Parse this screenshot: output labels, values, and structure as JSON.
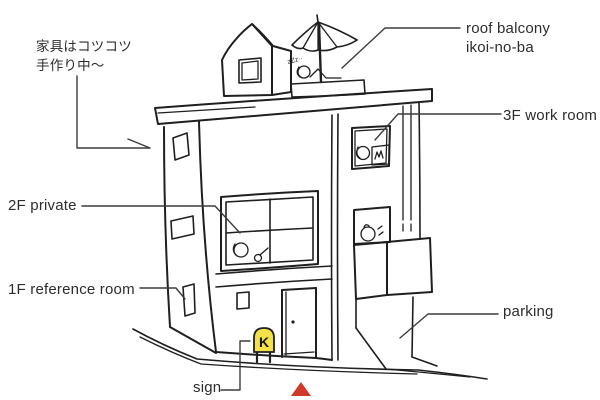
{
  "colors": {
    "ink": "#1f1f1f",
    "leader": "#3c3c3c",
    "label_text": "#2d2d2d",
    "sign_yellow": "#f2e14b",
    "marker_red": "#cf3928"
  },
  "labels": {
    "handmade_note": "家具はコツコツ\n手作り中〜",
    "roof_balcony": "roof balcony\nikoi-no-ba",
    "floor3_work_room": "3F work room",
    "floor2_private": "2F private",
    "floor1_reference_room": "1F reference room",
    "parking": "parking",
    "sign": "sign"
  },
  "sign": {
    "letter": "K"
  },
  "sketch_notes": {
    "sleep_zzz": "zZz··"
  }
}
